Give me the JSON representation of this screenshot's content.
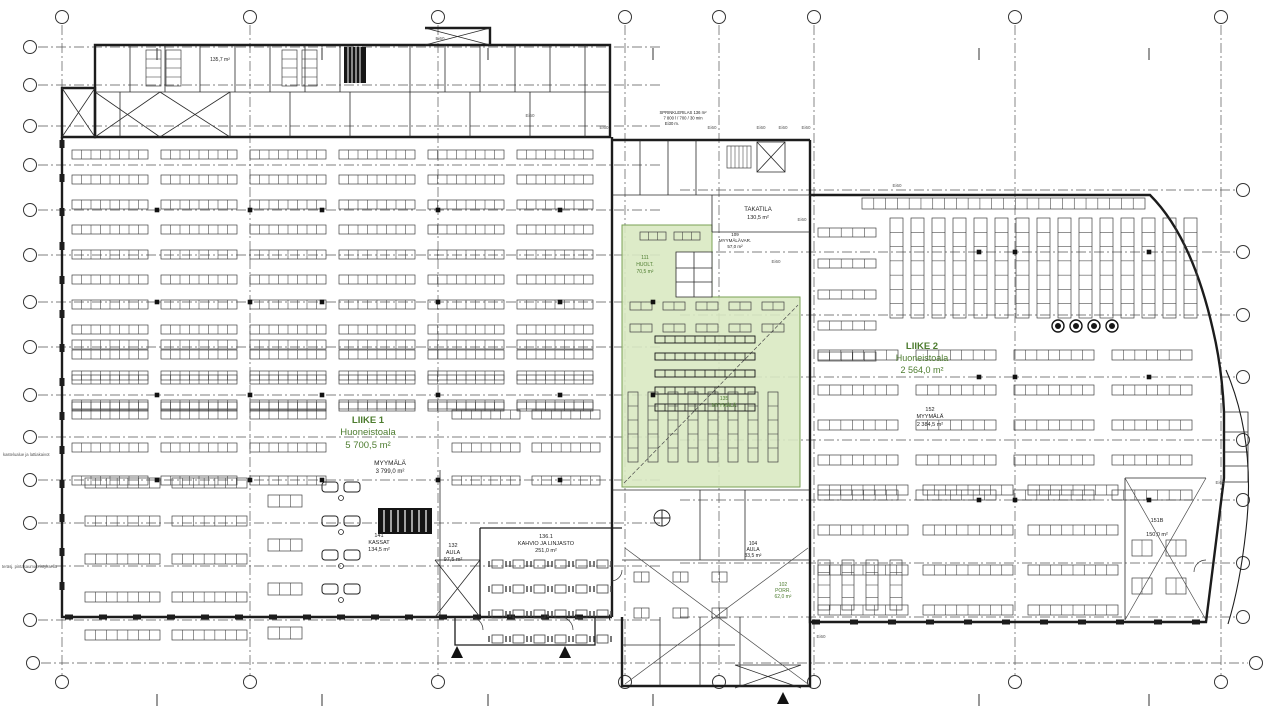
{
  "drawing": {
    "type": "architectural-floor-plan",
    "colors": {
      "wall": "#1c1c1c",
      "detail": "#3f3f3f",
      "grid": "#555555",
      "green_fill": "#d9e9c2",
      "green_edge": "#7aa055",
      "green_text": "#4d7c2f",
      "dark_text": "#222222",
      "gray_text": "#555555"
    },
    "grid": {
      "circle_radius": 6.5,
      "columns_x": [
        62,
        250,
        438,
        625,
        719,
        814,
        1015,
        1221
      ],
      "column_half_ticks_x": [
        157,
        322,
        488,
        653,
        979,
        1149
      ],
      "top_circle_y": 17,
      "bottom_circle_y": 682,
      "rows_left_y": [
        47,
        85,
        126,
        165,
        210,
        255,
        302,
        347,
        395,
        437,
        480,
        523,
        566,
        620
      ],
      "rows_left_circle_x": 30,
      "rows_right_y": [
        190,
        252,
        315,
        377,
        440,
        500,
        563,
        617
      ],
      "rows_right_circle_x": 1243,
      "rows_full_y": [
        663
      ],
      "rows_full_circle_x_left": 33,
      "rows_full_circle_x_right": 1256
    },
    "green_zones": [
      {
        "name": "highlighted-tenant-area",
        "points": "622,225 712,225 712,297 800,297 800,487 622,487"
      }
    ],
    "green_notch": {
      "x": 676,
      "y": 252,
      "w": 36,
      "h": 45
    },
    "labels": [
      {
        "t": "LIIKE 1",
        "x": 368,
        "y": 423,
        "s": 9.5,
        "c": "green_text",
        "b": 1
      },
      {
        "t": "Huoneistoala",
        "x": 368,
        "y": 435,
        "s": 9.5,
        "c": "green_text"
      },
      {
        "t": "5 700,5 m²",
        "x": 368,
        "y": 448,
        "s": 9.5,
        "c": "green_text"
      },
      {
        "t": "MYYMÄLÄ",
        "x": 390,
        "y": 465,
        "s": 6.5,
        "c": "dark_text"
      },
      {
        "t": "3 799,0 m²",
        "x": 390,
        "y": 473,
        "s": 6,
        "c": "dark_text"
      },
      {
        "t": "LIIKE 2",
        "x": 922,
        "y": 349,
        "s": 9.5,
        "c": "green_text",
        "b": 1
      },
      {
        "t": "Huoneistoala",
        "x": 922,
        "y": 361,
        "s": 9,
        "c": "green_text"
      },
      {
        "t": "2 564,0 m²",
        "x": 922,
        "y": 373,
        "s": 9,
        "c": "green_text"
      },
      {
        "t": "152",
        "x": 930,
        "y": 411,
        "s": 5.5,
        "c": "dark_text"
      },
      {
        "t": "MYYMÄLÄ",
        "x": 930,
        "y": 418,
        "s": 5.5,
        "c": "dark_text"
      },
      {
        "t": "2 384,5 m²",
        "x": 930,
        "y": 426,
        "s": 5.5,
        "c": "dark_text"
      },
      {
        "t": "TAKATILA",
        "x": 758,
        "y": 211,
        "s": 6,
        "c": "dark_text"
      },
      {
        "t": "130,5 m²",
        "x": 758,
        "y": 219,
        "s": 5.5,
        "c": "dark_text"
      },
      {
        "t": "111",
        "x": 645,
        "y": 259,
        "s": 5,
        "c": "green_text"
      },
      {
        "t": "HUOLT.",
        "x": 645,
        "y": 266,
        "s": 5,
        "c": "green_text"
      },
      {
        "t": "70,5 m²",
        "x": 645,
        "y": 273,
        "s": 5,
        "c": "green_text"
      },
      {
        "t": "109",
        "x": 735,
        "y": 236,
        "s": 4.5,
        "c": "dark_text"
      },
      {
        "t": "MYYMÄLÄVAR.",
        "x": 735,
        "y": 242,
        "s": 4.5,
        "c": "dark_text"
      },
      {
        "t": "57,0 m²",
        "x": 735,
        "y": 248,
        "s": 4.5,
        "c": "dark_text"
      },
      {
        "t": "135",
        "x": 724,
        "y": 400,
        "s": 5,
        "c": "green_text"
      },
      {
        "t": "MYYMÄLÄ",
        "x": 724,
        "y": 407,
        "s": 5,
        "c": "green_text"
      },
      {
        "t": "141",
        "x": 379,
        "y": 537,
        "s": 5.5,
        "c": "dark_text"
      },
      {
        "t": "KASSAT",
        "x": 379,
        "y": 544,
        "s": 5.5,
        "c": "dark_text"
      },
      {
        "t": "134,5 m²",
        "x": 379,
        "y": 551,
        "s": 5.5,
        "c": "dark_text"
      },
      {
        "t": "132",
        "x": 453,
        "y": 547,
        "s": 5.5,
        "c": "dark_text"
      },
      {
        "t": "AULA",
        "x": 453,
        "y": 554,
        "s": 5.5,
        "c": "dark_text"
      },
      {
        "t": "97,5 m²",
        "x": 453,
        "y": 561,
        "s": 5.5,
        "c": "dark_text"
      },
      {
        "t": "136.1",
        "x": 546,
        "y": 538,
        "s": 5.5,
        "c": "dark_text"
      },
      {
        "t": "KAHVIO JA LINJASTO",
        "x": 546,
        "y": 545,
        "s": 5.5,
        "c": "dark_text"
      },
      {
        "t": "251,0 m²",
        "x": 546,
        "y": 552,
        "s": 5.5,
        "c": "dark_text"
      },
      {
        "t": "104",
        "x": 753,
        "y": 545,
        "s": 5,
        "c": "dark_text"
      },
      {
        "t": "AULA",
        "x": 753,
        "y": 551,
        "s": 5,
        "c": "dark_text"
      },
      {
        "t": "33,5 m²",
        "x": 753,
        "y": 557,
        "s": 5,
        "c": "dark_text"
      },
      {
        "t": "102",
        "x": 783,
        "y": 586,
        "s": 5,
        "c": "green_text"
      },
      {
        "t": "PORR.",
        "x": 783,
        "y": 592,
        "s": 5,
        "c": "green_text"
      },
      {
        "t": "62,0 m²",
        "x": 783,
        "y": 598,
        "s": 5,
        "c": "green_text"
      },
      {
        "t": "151B",
        "x": 1157,
        "y": 522,
        "s": 5.5,
        "c": "dark_text"
      },
      {
        "t": "150,0 m²",
        "x": 1157,
        "y": 536,
        "s": 5.5,
        "c": "dark_text"
      },
      {
        "t": "135,7 m²",
        "x": 220,
        "y": 61,
        "s": 5,
        "c": "dark_text"
      },
      {
        "t": "SPRINKLERILAS 136 m²",
        "x": 683,
        "y": 114,
        "s": 4.2,
        "c": "dark_text"
      },
      {
        "t": "7 800 l / 700 / 30 min",
        "x": 683,
        "y": 119.5,
        "s": 4.2,
        "c": "dark_text"
      },
      {
        "t": "Ei30 m.",
        "x": 672,
        "y": 125,
        "s": 4.2,
        "c": "dark_text"
      },
      {
        "t": "kastelualue ja lattiakaivot",
        "x": 3,
        "y": 456,
        "s": 4.2,
        "c": "gray_text",
        "a": "start"
      },
      {
        "t": "teräsj. pintasaumaeristyksellä",
        "x": 2,
        "y": 568,
        "s": 4.2,
        "c": "gray_text",
        "a": "start"
      }
    ],
    "fire_rating_labels": [
      {
        "t": "Ei60",
        "x": 440,
        "y": 40
      },
      {
        "t": "Ei60",
        "x": 530,
        "y": 117
      },
      {
        "t": "Ei60",
        "x": 604,
        "y": 129
      },
      {
        "t": "Ei60",
        "x": 712,
        "y": 129
      },
      {
        "t": "Ei60",
        "x": 761,
        "y": 129
      },
      {
        "t": "Ei60",
        "x": 783,
        "y": 129
      },
      {
        "t": "Ei60",
        "x": 806,
        "y": 129
      },
      {
        "t": "Ei60",
        "x": 897,
        "y": 187
      },
      {
        "t": "Ei60",
        "x": 802,
        "y": 221
      },
      {
        "t": "Ei60",
        "x": 776,
        "y": 263
      },
      {
        "t": "Ei60",
        "x": 1220,
        "y": 484
      },
      {
        "t": "Ei60",
        "x": 821,
        "y": 638
      }
    ],
    "entrance_markers": [
      {
        "x": 457,
        "y": 651
      },
      {
        "x": 565,
        "y": 651
      },
      {
        "x": 783,
        "y": 697
      }
    ],
    "columns": [
      {
        "xs": [
          157,
          250,
          322,
          438,
          560
        ],
        "ys": [
          210,
          302,
          395,
          480
        ]
      },
      {
        "xs": [
          979,
          1015,
          1149
        ],
        "ys": [
          252,
          377,
          500
        ]
      },
      {
        "xs": [
          653
        ],
        "ys": [
          302,
          395
        ]
      }
    ],
    "fixture_zones": [
      {
        "k": "g",
        "x": 72,
        "y": 150,
        "r": 11,
        "c": 6,
        "w": 76,
        "h": 9,
        "gx": 13,
        "gy": 16,
        "vc": 8
      },
      {
        "k": "g",
        "x": 72,
        "y": 340,
        "r": 3,
        "c": 6,
        "w": 76,
        "h": 9,
        "gx": 13,
        "gy": 22,
        "vc": 8
      },
      {
        "k": "g",
        "x": 72,
        "y": 410,
        "r": 3,
        "c": 3,
        "w": 76,
        "h": 9,
        "gx": 13,
        "gy": 24,
        "vc": 8
      },
      {
        "k": "g",
        "x": 452,
        "y": 410,
        "r": 3,
        "c": 2,
        "w": 68,
        "h": 9,
        "gx": 12,
        "gy": 24,
        "vc": 7
      },
      {
        "k": "g",
        "x": 85,
        "y": 478,
        "r": 5,
        "c": 2,
        "w": 75,
        "h": 10,
        "gx": 12,
        "gy": 28,
        "vc": 7
      },
      {
        "k": "g",
        "x": 268,
        "y": 495,
        "r": 4,
        "c": 1,
        "w": 34,
        "h": 12,
        "gx": 0,
        "gy": 32,
        "vc": 3
      },
      {
        "k": "g",
        "x": 862,
        "y": 198,
        "r": 1,
        "c": 1,
        "w": 283,
        "h": 11,
        "gx": 0,
        "gy": 0,
        "vc": 24
      },
      {
        "k": "g",
        "x": 890,
        "y": 218,
        "r": 1,
        "c": 15,
        "w": 13,
        "h": 100,
        "gx": 8,
        "gy": 0,
        "hc": 7
      },
      {
        "k": "g",
        "x": 818,
        "y": 228,
        "r": 5,
        "c": 1,
        "w": 58,
        "h": 9,
        "gx": 0,
        "gy": 22,
        "vc": 5
      },
      {
        "k": "g",
        "x": 818,
        "y": 350,
        "r": 5,
        "c": 4,
        "w": 80,
        "h": 10,
        "gx": 18,
        "gy": 25,
        "vc": 7
      },
      {
        "k": "g",
        "x": 818,
        "y": 485,
        "r": 4,
        "c": 3,
        "w": 90,
        "h": 10,
        "gx": 15,
        "gy": 30,
        "vc": 8
      },
      {
        "k": "g",
        "x": 818,
        "y": 560,
        "r": 1,
        "c": 4,
        "w": 12,
        "h": 50,
        "gx": 12,
        "gy": 0,
        "hc": 4
      },
      {
        "k": "g",
        "x": 655,
        "y": 336,
        "r": 5,
        "c": 1,
        "w": 100,
        "h": 7,
        "gx": 0,
        "gy": 10,
        "vc": 10,
        "dark": 1
      },
      {
        "k": "g",
        "x": 628,
        "y": 392,
        "r": 1,
        "c": 8,
        "w": 10,
        "h": 70,
        "gx": 10,
        "gy": 0,
        "hc": 5
      },
      {
        "k": "g",
        "x": 630,
        "y": 302,
        "r": 2,
        "c": 5,
        "w": 22,
        "h": 8,
        "gx": 11,
        "gy": 14,
        "vc": 2
      },
      {
        "k": "g",
        "x": 640,
        "y": 232,
        "r": 1,
        "c": 2,
        "w": 26,
        "h": 8,
        "gx": 8,
        "gy": 0,
        "vc": 3
      },
      {
        "k": "g",
        "x": 146,
        "y": 50,
        "r": 1,
        "c": 2,
        "w": 15,
        "h": 36,
        "gx": 5,
        "gy": 0,
        "hc": 4
      },
      {
        "k": "g",
        "x": 282,
        "y": 50,
        "r": 1,
        "c": 2,
        "w": 15,
        "h": 36,
        "gx": 5,
        "gy": 0,
        "hc": 4
      },
      {
        "k": "g",
        "x": 634,
        "y": 572,
        "r": 2,
        "c": 3,
        "w": 15,
        "h": 10,
        "gx": 24,
        "gy": 26,
        "vc": 2
      },
      {
        "k": "g",
        "x": 727,
        "y": 146,
        "r": 1,
        "c": 1,
        "w": 24,
        "h": 22,
        "gx": 0,
        "gy": 0,
        "vc": 6
      },
      {
        "k": "g",
        "x": 1132,
        "y": 540,
        "r": 2,
        "c": 2,
        "w": 20,
        "h": 16,
        "gx": 14,
        "gy": 22,
        "vc": 2
      },
      {
        "k": "c",
        "x": 1058,
        "y": 326,
        "n": 4,
        "p": 18,
        "rr": 6
      },
      {
        "k": "t",
        "x": 492,
        "y": 560,
        "r": 4,
        "c": 6,
        "px": 21,
        "py": 25
      },
      {
        "k": "q",
        "x": 322,
        "ys": [
          482,
          516,
          550,
          584
        ]
      }
    ]
  }
}
